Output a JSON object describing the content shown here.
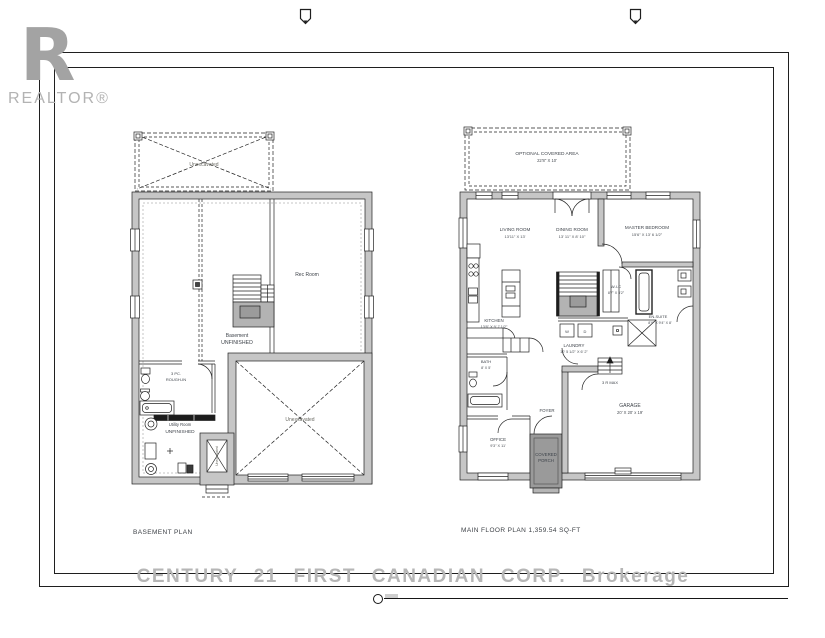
{
  "sheet": {
    "realtor_logo": {
      "letter": "R",
      "label": "REALTOR®"
    },
    "watermark": "CENTURY 21 FIRST CANADIAN CORP. Brokerage"
  },
  "basement": {
    "caption": "BASEMENT PLAN",
    "labels": {
      "deck": "Unexcavated",
      "rec_room": "Rec Room",
      "basement_line1": "Basement",
      "basement_line2": "UNFINISHED",
      "rough_in_line1": "3 PC.",
      "rough_in_line2": "ROUGH-IN",
      "utility_line1": "Utility Room",
      "utility_line2": "UNFINISHED",
      "unexcavated_main": "Unexcavated",
      "unexcavated_cellar": "Unexcavated"
    }
  },
  "main_floor": {
    "caption": "MAIN FLOOR PLAN 1,359.54 SQ-FT",
    "labels": {
      "optional_area_name": "OPTIONAL COVERED AREA",
      "optional_area_dims": "22'8\" X 10'",
      "living_name": "LIVING ROOM",
      "living_dims": "13'11\" X 13'",
      "dining_name": "DINING ROOM",
      "dining_dims": "13' 11\" X 8' 10\"",
      "master_name": "MASTER BEDROOM",
      "master_dims": "15'6\" X 13' 6 1/2\"",
      "kitchen_name": "KITCHEN",
      "kitchen_dims": "13'6\" X 9' 7 1/2\"",
      "wic_name": "W-I-C",
      "wic_dims": "8'7\" X 5'2\"",
      "ensuite_name": "EN-SUITE",
      "ensuite_dims": "8'9\" X 9'4\" X 8'",
      "laundry_name": "LAUNDRY",
      "laundry_dims": "10' 5 1/2\" X 6' 2\"",
      "washer": "W",
      "dryer": "D",
      "bath_name": "BATH",
      "bath_dims": "8' X 5'",
      "foyer": "FOYER",
      "office_name": "OFFICE",
      "office_dims": "9'3\" X 11'",
      "porch_line1": "COVERED",
      "porch_line2": "PORCH",
      "garage_name": "GARAGE",
      "garage_dims": "20' X 20' x 19'",
      "garage_stairs": "3 R MAX"
    }
  },
  "colors": {
    "wall_gray": "#c6c6c6",
    "porch_gray": "#9a9a9a",
    "stair_gray": "#b3b3b3",
    "label": "#3f444b",
    "watermark_gray": "#b6b6b6",
    "line": "#1f1f1f"
  }
}
